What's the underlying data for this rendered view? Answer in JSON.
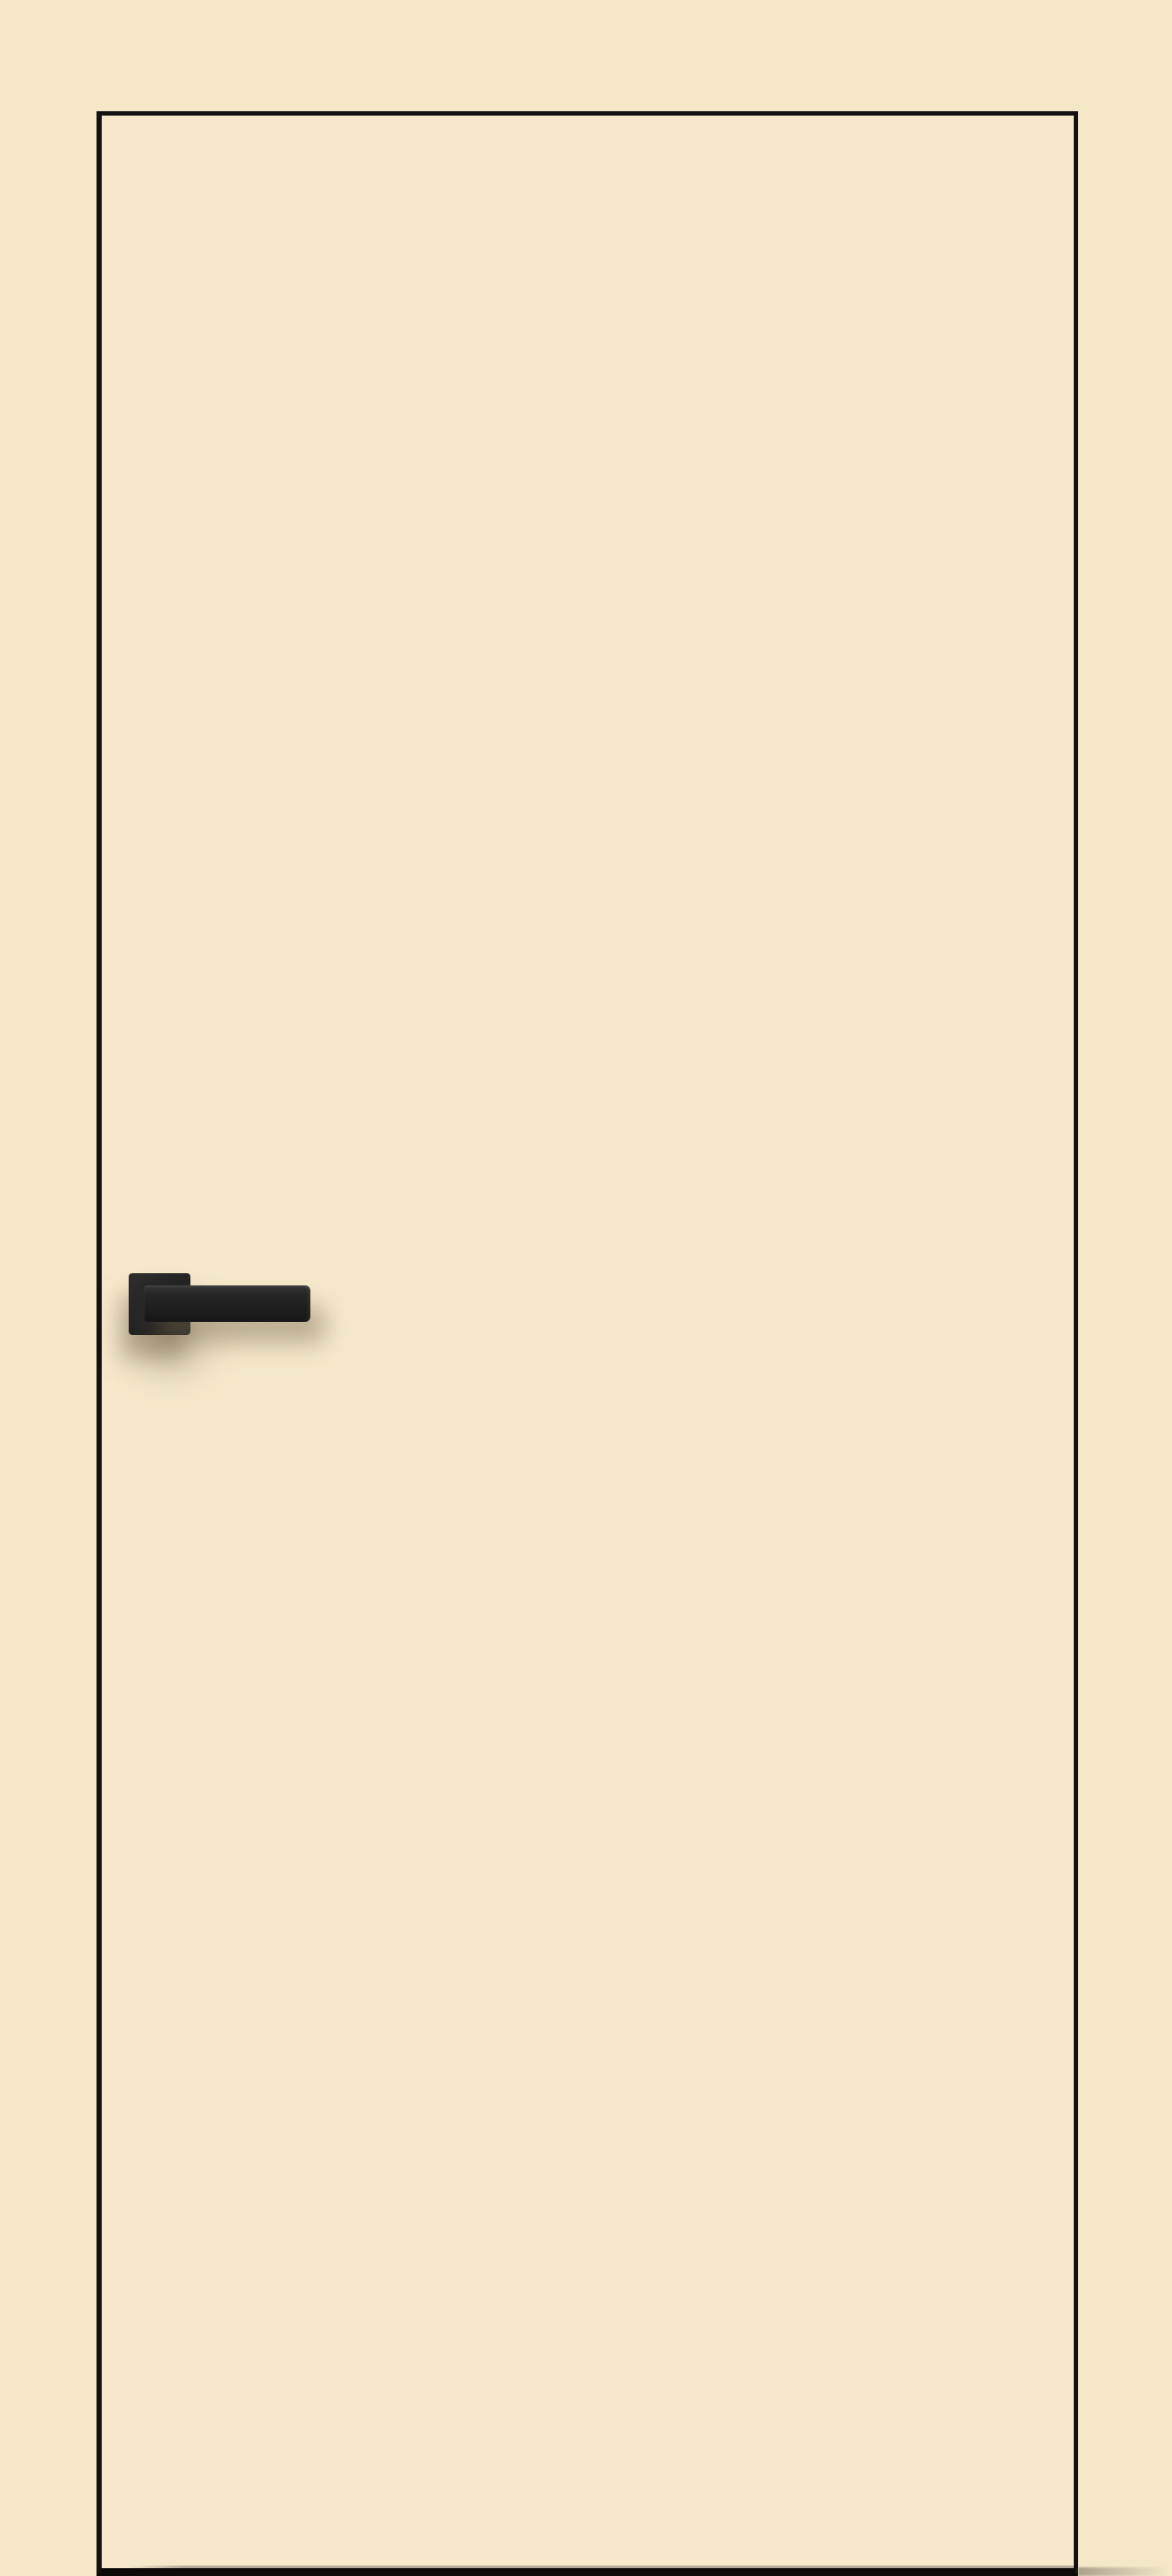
{
  "scene": {
    "description": "Product photo of a flush cream-colored interior door leaf with a thin black edge outline and a matte-black square-rose lever handle mounted on the left side at mid height",
    "door": {
      "finish": "cream",
      "style": "flush-flat-panel",
      "handle_side": "left",
      "handle_style": "square-rose-straight-lever",
      "hinges_visible": "none",
      "glazing": "none",
      "text_visible": "none"
    }
  },
  "colors": {
    "background": "#f5e8c9",
    "door_face": "#f6e9cb",
    "door_outline": "#141210",
    "door_bottom_edge": "#0c0b09",
    "inner_bottom_shadow": "#9b9588",
    "handle_dark": "#1c1c1c",
    "handle_mid": "#252525",
    "handle_highlight": "#2e2e2e",
    "handle_shadow": "rgba(124,110,82,0.5)"
  }
}
